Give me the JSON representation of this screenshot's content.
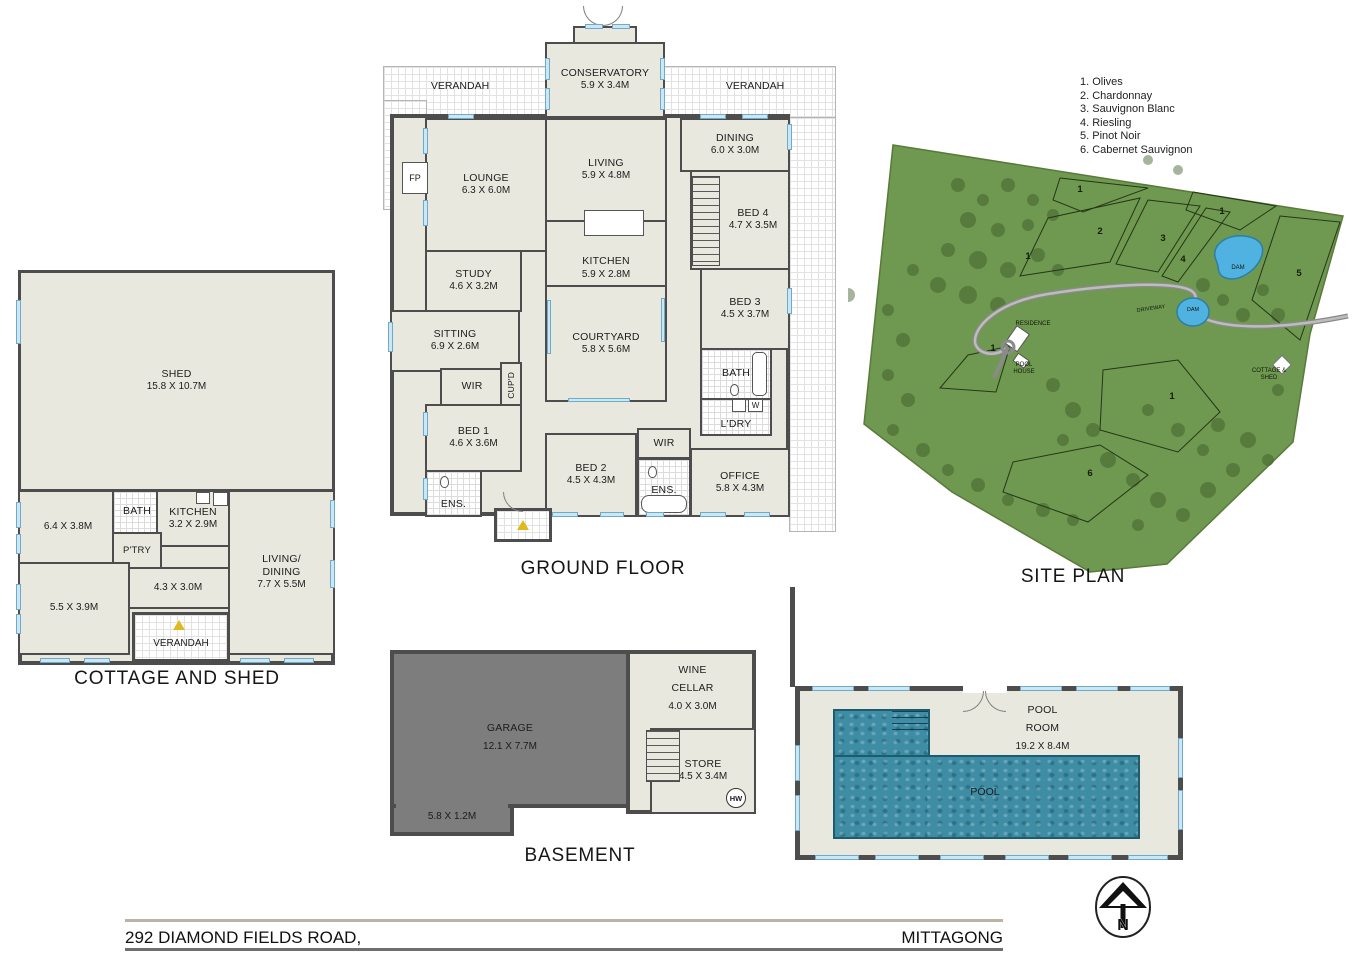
{
  "legend": {
    "items": [
      "1. Olives",
      "2. Chardonnay",
      "3. Sauvignon Blanc",
      "4. Riesling",
      "5. Pinot Noir",
      "6. Cabernet Sauvignon"
    ]
  },
  "ground_floor": {
    "title": "GROUND FLOOR",
    "verandah": "VERANDAH",
    "rooms": {
      "conservatory": {
        "name": "CONSERVATORY",
        "dims": "5.9 X 3.4M"
      },
      "lounge": {
        "name": "LOUNGE",
        "dims": "6.3 X 6.0M"
      },
      "living": {
        "name": "LIVING",
        "dims": "5.9 X 4.8M"
      },
      "kitchen": {
        "name": "KITCHEN",
        "dims": "5.9 X 2.8M"
      },
      "dining": {
        "name": "DINING",
        "dims": "6.0 X 3.0M"
      },
      "bed4": {
        "name": "BED 4",
        "dims": "4.7 X 3.5M"
      },
      "bed3": {
        "name": "BED 3",
        "dims": "4.5 X 3.7M"
      },
      "study": {
        "name": "STUDY",
        "dims": "4.6 X 3.2M"
      },
      "sitting": {
        "name": "SITTING",
        "dims": "6.9 X 2.6M"
      },
      "courtyard": {
        "name": "COURTYARD",
        "dims": "5.8 X 5.6M"
      },
      "wir_a": {
        "name": "WIR"
      },
      "cupd": {
        "name": "CUP'D"
      },
      "bath": {
        "name": "BATH"
      },
      "ldry": {
        "name": "L'DRY"
      },
      "bed1": {
        "name": "BED 1",
        "dims": "4.6 X 3.6M"
      },
      "ens_a": {
        "name": "ENS."
      },
      "bed2": {
        "name": "BED 2",
        "dims": "4.5 X 4.3M"
      },
      "wir_b": {
        "name": "WIR"
      },
      "ens_b": {
        "name": "ENS."
      },
      "office": {
        "name": "OFFICE",
        "dims": "5.8 X 4.3M"
      },
      "fp": {
        "name": "FP"
      },
      "w": {
        "name": "W"
      }
    }
  },
  "cottage": {
    "title": "COTTAGE AND SHED",
    "rooms": {
      "shed": {
        "name": "SHED",
        "dims": "15.8 X 10.7M"
      },
      "room_a": {
        "dims": "6.4 X 3.8M"
      },
      "bath": {
        "name": "BATH"
      },
      "kitchen": {
        "name": "KITCHEN",
        "dims": "3.2 X 2.9M"
      },
      "ptry": {
        "name": "P'TRY"
      },
      "hall": {
        "dims": "4.3 X 3.0M"
      },
      "living_dining": {
        "name": "LIVING/\nDINING",
        "dims": "7.7 X 5.5M"
      },
      "room_b": {
        "dims": "5.5 X 3.9M"
      },
      "verandah": {
        "name": "VERANDAH"
      }
    }
  },
  "basement": {
    "title": "BASEMENT",
    "rooms": {
      "garage": {
        "name": "GARAGE",
        "dims": "12.1 X 7.7M"
      },
      "strip": {
        "dims": "5.8 X 1.2M"
      },
      "wine_cellar": {
        "name": "WINE\nCELLAR",
        "dims": "4.0 X 3.0M"
      },
      "store": {
        "name": "STORE",
        "dims": "4.5 X 3.4M"
      },
      "hw": {
        "name": "HW"
      }
    }
  },
  "pool_room": {
    "name": "POOL\nROOM",
    "dims": "19.2 X 8.4M",
    "pool": "POOL"
  },
  "site_plan": {
    "title": "SITE PLAN",
    "labels": {
      "residence": "RESIDENCE",
      "pool_house": "POOL\nHOUSE",
      "cottage_shed": "COTTAGE &\nSHED",
      "driveway": "DRIVEWAY",
      "dam": "DAM"
    },
    "blocks": [
      "1",
      "2",
      "3",
      "4",
      "1",
      "5",
      "1",
      "1",
      "1",
      "6"
    ]
  },
  "footer": {
    "address": "292 DIAMOND FIELDS ROAD,",
    "suburb": "MITTAGONG",
    "north": "N"
  }
}
